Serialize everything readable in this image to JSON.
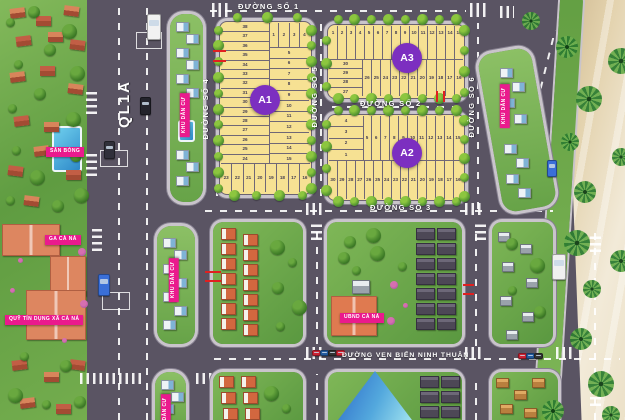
{
  "plan": {
    "streets": {
      "ql1a": "QL1A",
      "so1": "ĐƯỜNG SỐ 1",
      "so2": "ĐƯỜNG SỐ 2",
      "so3": "ĐƯỜNG SỐ 3",
      "so4": "ĐƯỜNG SỐ 4",
      "so5": "ĐƯỜNG SỐ 5",
      "so6": "ĐƯỜNG SỐ 6",
      "coastal": "ĐƯỜNG VEN BIỂN NINH THUẬN"
    },
    "poi": {
      "san_bong": "SÂN BÓNG",
      "ga_ca_na": "GA CÀ NÁ",
      "quy_tin_dung": "QUỸ TÍN DỤNG XÃ CÀ NÁ",
      "ubnd": "UBND CÀ NÁ",
      "khu_dan_cu": "KHU DÂN CƯ"
    },
    "blocks": [
      {
        "id": "A1",
        "label": "A1",
        "left_col": [
          38,
          37,
          36,
          35,
          34,
          33,
          32,
          31,
          30,
          29,
          28,
          27,
          26,
          25,
          24
        ],
        "top_row": [
          1,
          2,
          3,
          4
        ],
        "right_col": [
          5,
          6,
          7,
          8,
          9,
          10,
          11,
          12,
          13,
          14,
          15
        ],
        "bottom_row": [
          23,
          22,
          21,
          20,
          19,
          18,
          17,
          16
        ]
      },
      {
        "id": "A3",
        "label": "A3",
        "top_row": [
          1,
          2,
          3,
          4,
          5,
          6,
          7,
          8,
          9,
          10,
          11,
          12,
          13,
          14,
          15
        ],
        "left_col": [
          30,
          29,
          28,
          27
        ],
        "bottom_row": [
          26,
          25,
          24,
          23,
          22,
          21,
          20,
          19,
          18,
          17,
          16
        ]
      },
      {
        "id": "A2",
        "label": "A2",
        "left_col": [
          4,
          3,
          2,
          1
        ],
        "top_row": [
          5,
          6,
          7,
          8,
          9,
          10,
          11,
          12,
          13,
          14,
          15
        ],
        "bottom_row": [
          30,
          29,
          28,
          27,
          26,
          25,
          24,
          23,
          22,
          21,
          20,
          19,
          18,
          17,
          16
        ]
      }
    ],
    "colors": {
      "road": "#5a5463",
      "lot_yellow": "#f6e193",
      "block_circle": "#7c2fc0",
      "poi_pink": "#ea1a8d",
      "sand": "#e3d2ad",
      "green": "#6fae4e"
    }
  }
}
